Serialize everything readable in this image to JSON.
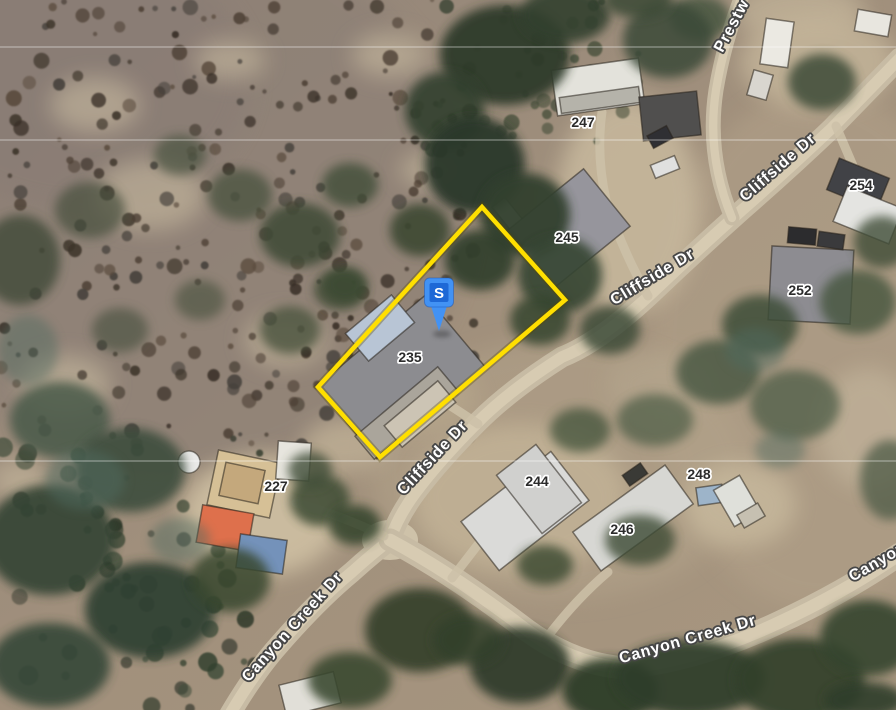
{
  "map": {
    "marker": {
      "label": "S",
      "x": 439,
      "y": 293,
      "pin_color": "#4292f4",
      "inner_color": "#1e68d6",
      "label_color": "#ffffff"
    },
    "parcel": {
      "outline_color": "#ffdf00",
      "points": [
        [
          482,
          207
        ],
        [
          565,
          300
        ],
        [
          380,
          457
        ],
        [
          318,
          387
        ]
      ]
    },
    "street_labels": [
      {
        "text": "Prestw",
        "x": 736,
        "y": 28,
        "rotation": -62
      },
      {
        "text": "Cliffside Dr",
        "x": 781,
        "y": 171,
        "rotation": -41
      },
      {
        "text": "Cliffside Dr",
        "x": 655,
        "y": 281,
        "rotation": -31
      },
      {
        "text": "Cliffside Dr",
        "x": 436,
        "y": 461,
        "rotation": -47
      },
      {
        "text": "Canyon Creek Dr",
        "x": 296,
        "y": 630,
        "rotation": -48
      },
      {
        "text": "Canyon Creek Dr",
        "x": 689,
        "y": 644,
        "rotation": -16
      },
      {
        "text": "Canyon",
        "x": 880,
        "y": 566,
        "rotation": -30
      }
    ],
    "house_numbers": [
      {
        "text": "247",
        "x": 583,
        "y": 122
      },
      {
        "text": "245",
        "x": 567,
        "y": 237
      },
      {
        "text": "254",
        "x": 861,
        "y": 185
      },
      {
        "text": "252",
        "x": 800,
        "y": 290
      },
      {
        "text": "235",
        "x": 410,
        "y": 357
      },
      {
        "text": "227",
        "x": 276,
        "y": 486
      },
      {
        "text": "244",
        "x": 537,
        "y": 481
      },
      {
        "text": "246",
        "x": 622,
        "y": 529
      },
      {
        "text": "248",
        "x": 699,
        "y": 474
      }
    ]
  }
}
